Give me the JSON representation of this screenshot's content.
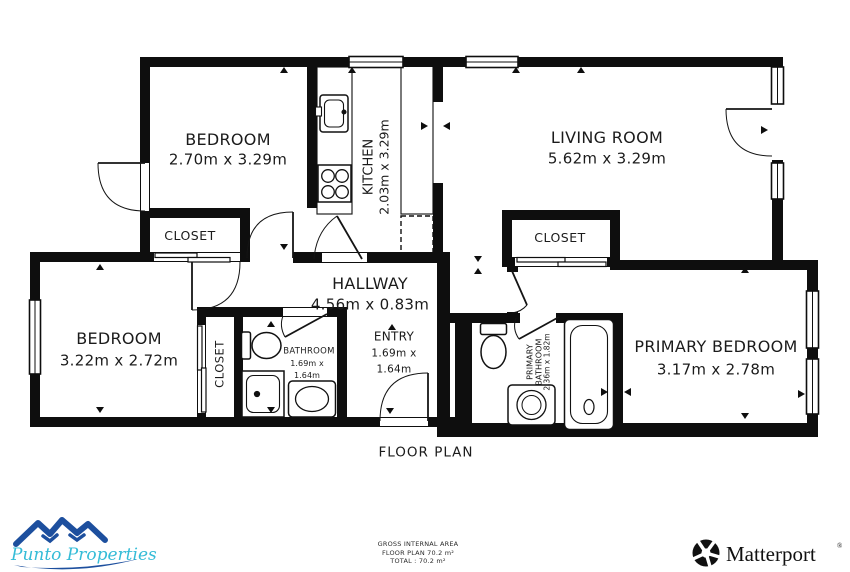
{
  "plan": {
    "title": "FLOOR PLAN",
    "rooms": {
      "bedroom_top": {
        "name": "BEDROOM",
        "dims": "2.70m x 3.29m"
      },
      "kitchen": {
        "name": "KITCHEN",
        "dims": "2.03m x 3.29m"
      },
      "living_room": {
        "name": "LIVING ROOM",
        "dims": "5.62m x 3.29m"
      },
      "closet_top": {
        "name": "CLOSET"
      },
      "closet_primary": {
        "name": "CLOSET"
      },
      "hallway": {
        "name": "HALLWAY",
        "dims": "4.56m x 0.83m"
      },
      "bedroom_left": {
        "name": "BEDROOM",
        "dims": "3.22m x 2.72m"
      },
      "closet_left": {
        "name": "CLOSET"
      },
      "bathroom": {
        "name": "BATHROOM",
        "dims_line1": "1.69m x",
        "dims_line2": "1.64m"
      },
      "entry": {
        "name": "ENTRY",
        "dims_line1": "1.69m x",
        "dims_line2": "1.64m"
      },
      "primary_bathroom": {
        "name_line1": "PRIMARY",
        "name_line2": "BATHROOM",
        "dims": "2.36m x 1.82m"
      },
      "primary_bedroom": {
        "name": "PRIMARY BEDROOM",
        "dims": "3.17m x 2.78m"
      }
    },
    "footer": {
      "line1": "GROSS INTERNAL AREA",
      "line2": "FLOOR PLAN 70.2 m²",
      "line3": "TOTAL :  70.2 m²"
    }
  },
  "branding": {
    "agency": "Punto Properties",
    "provider": "Matterport",
    "registered_mark": "®"
  },
  "colors": {
    "wall": "#0e0e0e",
    "agency_mountain_blue": "#1d4f9e",
    "agency_text_teal": "#35bcd7",
    "provider_black": "#101010"
  }
}
